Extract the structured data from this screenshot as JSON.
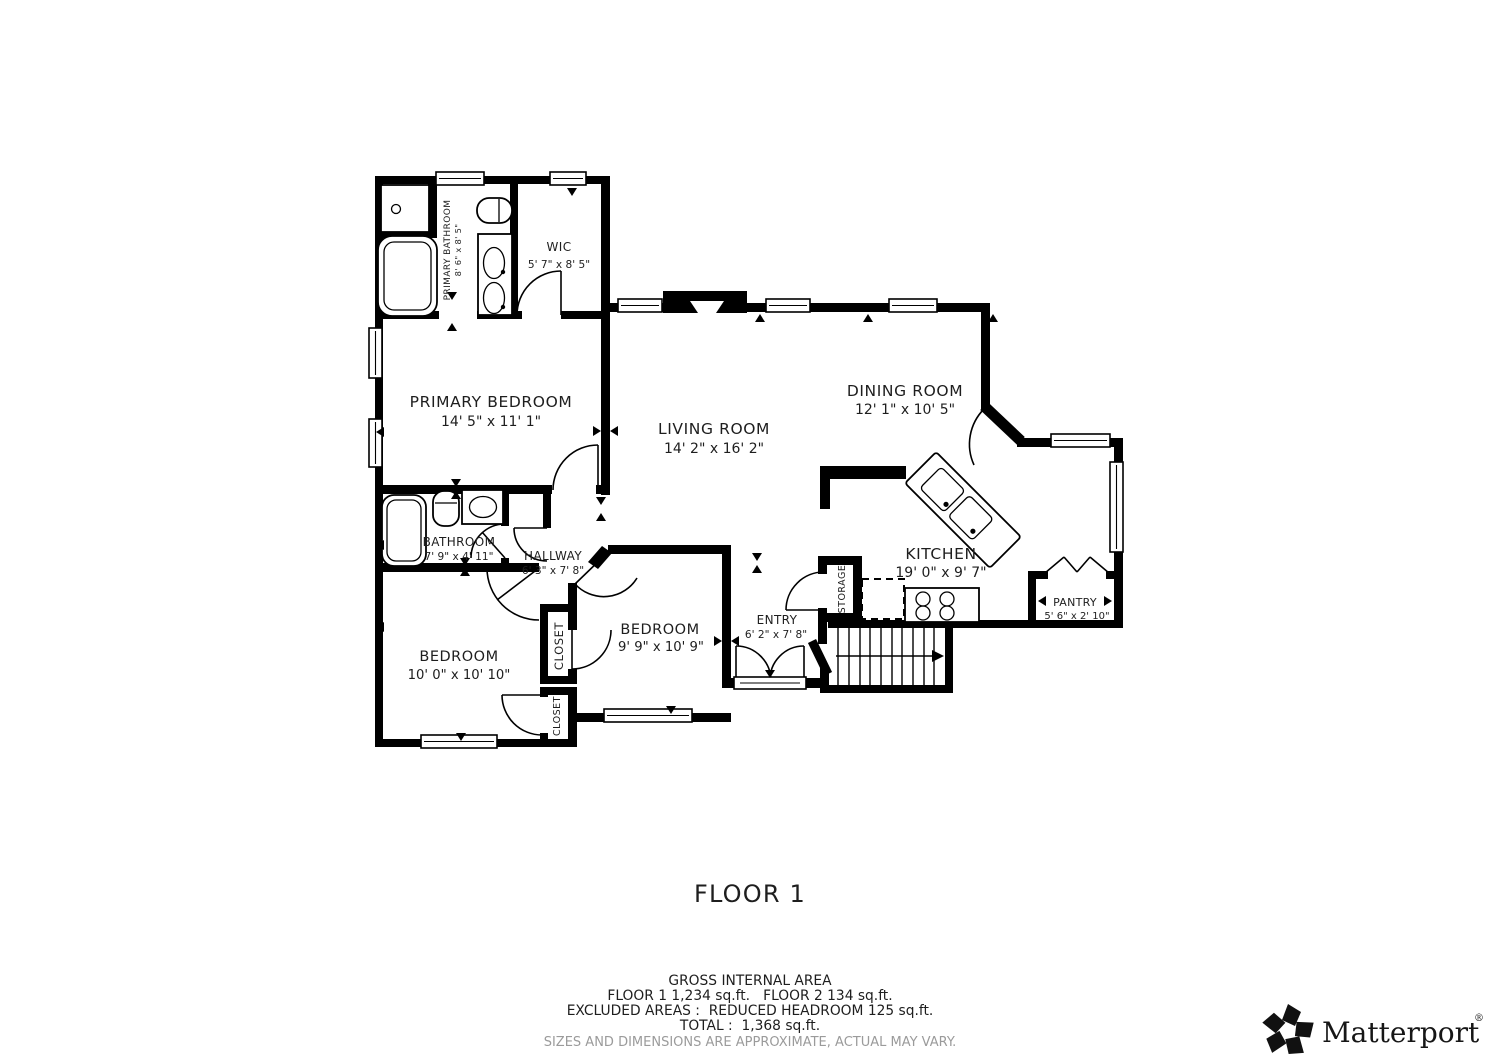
{
  "floor_label": "FLOOR 1",
  "rooms": {
    "primary_bathroom": {
      "name": "PRIMARY BATHROOM",
      "dims": "8' 6\" x 8' 5\""
    },
    "wic": {
      "name": "WIC",
      "dims": "5' 7\" x 8' 5\""
    },
    "primary_bedroom": {
      "name": "PRIMARY BEDROOM",
      "dims": "14' 5\" x 11' 1\""
    },
    "living_room": {
      "name": "LIVING ROOM",
      "dims": "14' 2\" x 16' 2\""
    },
    "dining_room": {
      "name": "DINING ROOM",
      "dims": "12' 1\" x 10' 5\""
    },
    "kitchen": {
      "name": "KITCHEN",
      "dims": "19' 0\" x 9' 7\""
    },
    "pantry": {
      "name": "PANTRY",
      "dims": "5' 6\" x 2' 10\""
    },
    "bathroom": {
      "name": "BATHROOM",
      "dims": "7' 9\" x 4' 11\""
    },
    "hallway": {
      "name": "HALLWAY",
      "dims": "6' 3\" x 7' 8\""
    },
    "bedroom_left": {
      "name": "BEDROOM",
      "dims": "10' 0\" x 10' 10\""
    },
    "bedroom_right": {
      "name": "BEDROOM",
      "dims": "9' 9\" x 10' 9\""
    },
    "entry": {
      "name": "ENTRY",
      "dims": "6' 2\" x 7' 8\""
    },
    "storage": {
      "name": "STORAGE"
    },
    "closet_upper": {
      "name": "CLOSET"
    },
    "closet_lower": {
      "name": "CLOSET"
    }
  },
  "footer": {
    "line1": "GROSS INTERNAL AREA",
    "line2": "FLOOR 1 1,234 sq.ft.   FLOOR 2 134 sq.ft.",
    "line3": "EXCLUDED AREAS :  REDUCED HEADROOM 125 sq.ft.",
    "line4": "TOTAL :  1,368 sq.ft.",
    "disclaimer": "SIZES AND DIMENSIONS ARE APPROXIMATE, ACTUAL MAY VARY."
  },
  "brand": {
    "wordmark": "Matterport",
    "registered": "®"
  }
}
